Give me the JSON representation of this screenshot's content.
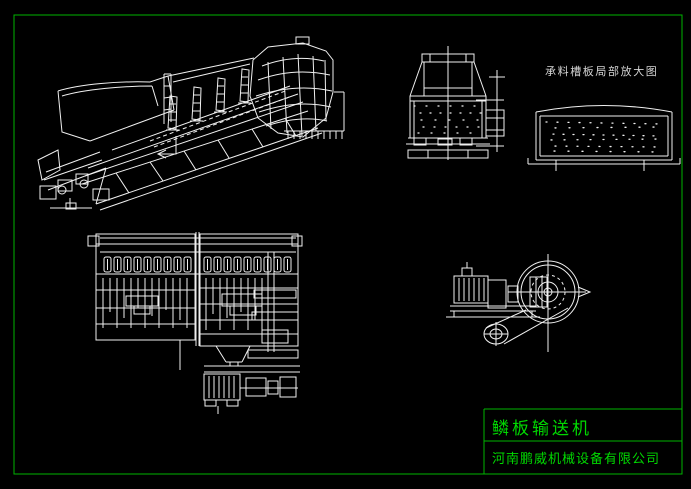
{
  "colors": {
    "bg": "#000000",
    "frame-green": "#00b400",
    "text-green": "#00d900",
    "line-white": "#f0f0f0",
    "label-gray": "#d4d4d4"
  },
  "labels": {
    "detail_view_title": "承料槽板局部放大图"
  },
  "title_block": {
    "drawing_name": "鳞板输送机",
    "company_name": "河南鹏威机械设备有限公司"
  }
}
